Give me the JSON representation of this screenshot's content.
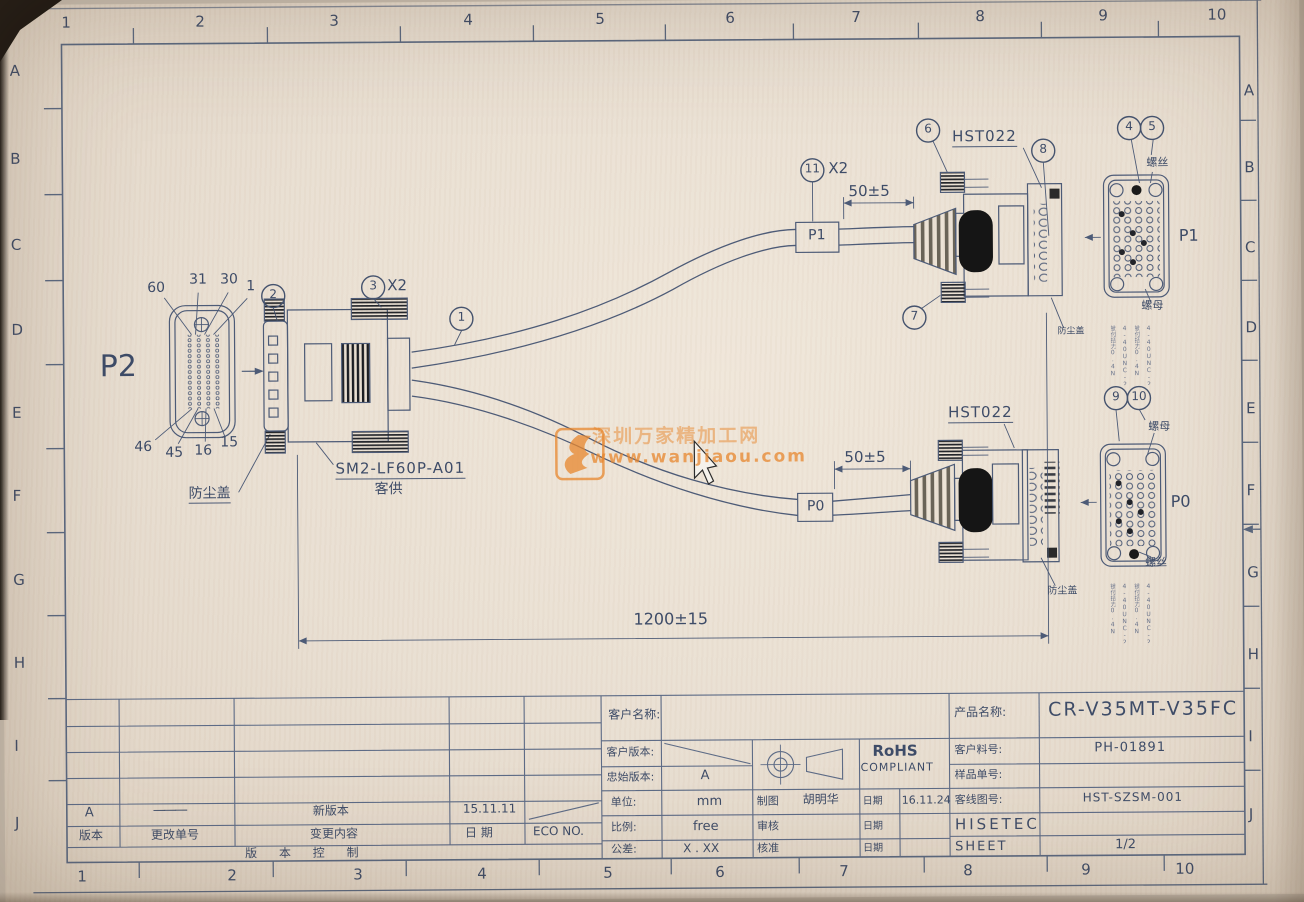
{
  "rulers": {
    "top": [
      "1",
      "2",
      "3",
      "4",
      "5",
      "6",
      "7",
      "8",
      "9",
      "10"
    ],
    "bottom": [
      "1",
      "2",
      "3",
      "4",
      "5",
      "6",
      "7",
      "8",
      "9",
      "10"
    ],
    "left": [
      "A",
      "B",
      "C",
      "D",
      "E",
      "F",
      "G",
      "H",
      "I",
      "J"
    ],
    "right": [
      "A",
      "B",
      "C",
      "D",
      "E",
      "F",
      "G",
      "H",
      "I",
      "J"
    ]
  },
  "drawing": {
    "p2": {
      "label": "P2",
      "pin_60": "60",
      "pin_31": "31",
      "pin_30": "30",
      "pin_1": "1",
      "pin_46": "46",
      "pin_45": "45",
      "pin_16": "16",
      "pin_15": "15",
      "dust_cover": "防尘盖",
      "part_no": "SM2-LF60P-A01",
      "supplied": "客供"
    },
    "balloons": {
      "n1": "1",
      "n2": "2",
      "n3": "3",
      "n3_qty": "X2",
      "n4": "4",
      "n5": "5",
      "n6": "6",
      "n7": "7",
      "n8": "8",
      "n9": "9",
      "n10": "10",
      "n11": "11",
      "n11_qty": "X2"
    },
    "branch_p1": {
      "tag": "P1",
      "part": "HST022",
      "dim": "50±5",
      "screw_label": "螺丝",
      "nut_label": "螺母",
      "dust_cover": "防尘盖",
      "face_label": "P1",
      "legend": [
        "锁付扭力0.4N",
        "4-40UNC-2A",
        "锁付扭力0.4N",
        "4-40UNC-2B"
      ]
    },
    "branch_p0": {
      "tag": "P0",
      "part": "HST022",
      "dim": "50±5",
      "screw_label": "螺丝",
      "nut_label": "螺母",
      "dust_cover": "防尘盖",
      "face_label": "P0",
      "legend": [
        "锁付扭力0.4N",
        "4-40UNC-2A",
        "锁付扭力0.4N",
        "4-40UNC-2B"
      ]
    },
    "overall_dim": "1200±15",
    "watermark": {
      "line1": "深圳万家精加工网",
      "line2": "www.wanjiaou.com"
    }
  },
  "title_block": {
    "customer_name_label": "客户名称:",
    "customer_rev_label": "客户版本:",
    "origin_rev_label": "忠始版本:",
    "origin_rev_value": "A",
    "unit_label": "单位:",
    "unit_value": "mm",
    "scale_label": "比例:",
    "scale_value": "free",
    "tol_label": "公差:",
    "tol_value": "X . XX",
    "drawn_label": "制图",
    "drawn_by": "胡明华",
    "checked_label": "审核",
    "approved_label": "核准",
    "date_label": "日期",
    "date_label2": "日期",
    "date_label3": "日期",
    "drawn_date": "16.11.24",
    "rohs1": "RoHS",
    "rohs2": "COMPLIANT",
    "product_label": "产品名称:",
    "product_value": "CR-V35MT-V35FC",
    "cust_pn_label": "客户料号:",
    "cust_pn_value": "PH-01891",
    "sample_label": "样品单号:",
    "dwg_no_label": "客线图号:",
    "dwg_no_value": "HST-SZSM-001",
    "company": "HISETEC",
    "sheet_label": "SHEET",
    "sheet_value": "1/2"
  },
  "revision": {
    "row_rev": "A",
    "row_change_no": "———",
    "row_desc": "新版本",
    "row_date": "15.11.11",
    "h_rev": "版本",
    "h_change_no": "更改单号",
    "h_desc": "变更内容",
    "h_date": "日 期",
    "h_eco": "ECO NO.",
    "footer": "版 本 控 制"
  }
}
